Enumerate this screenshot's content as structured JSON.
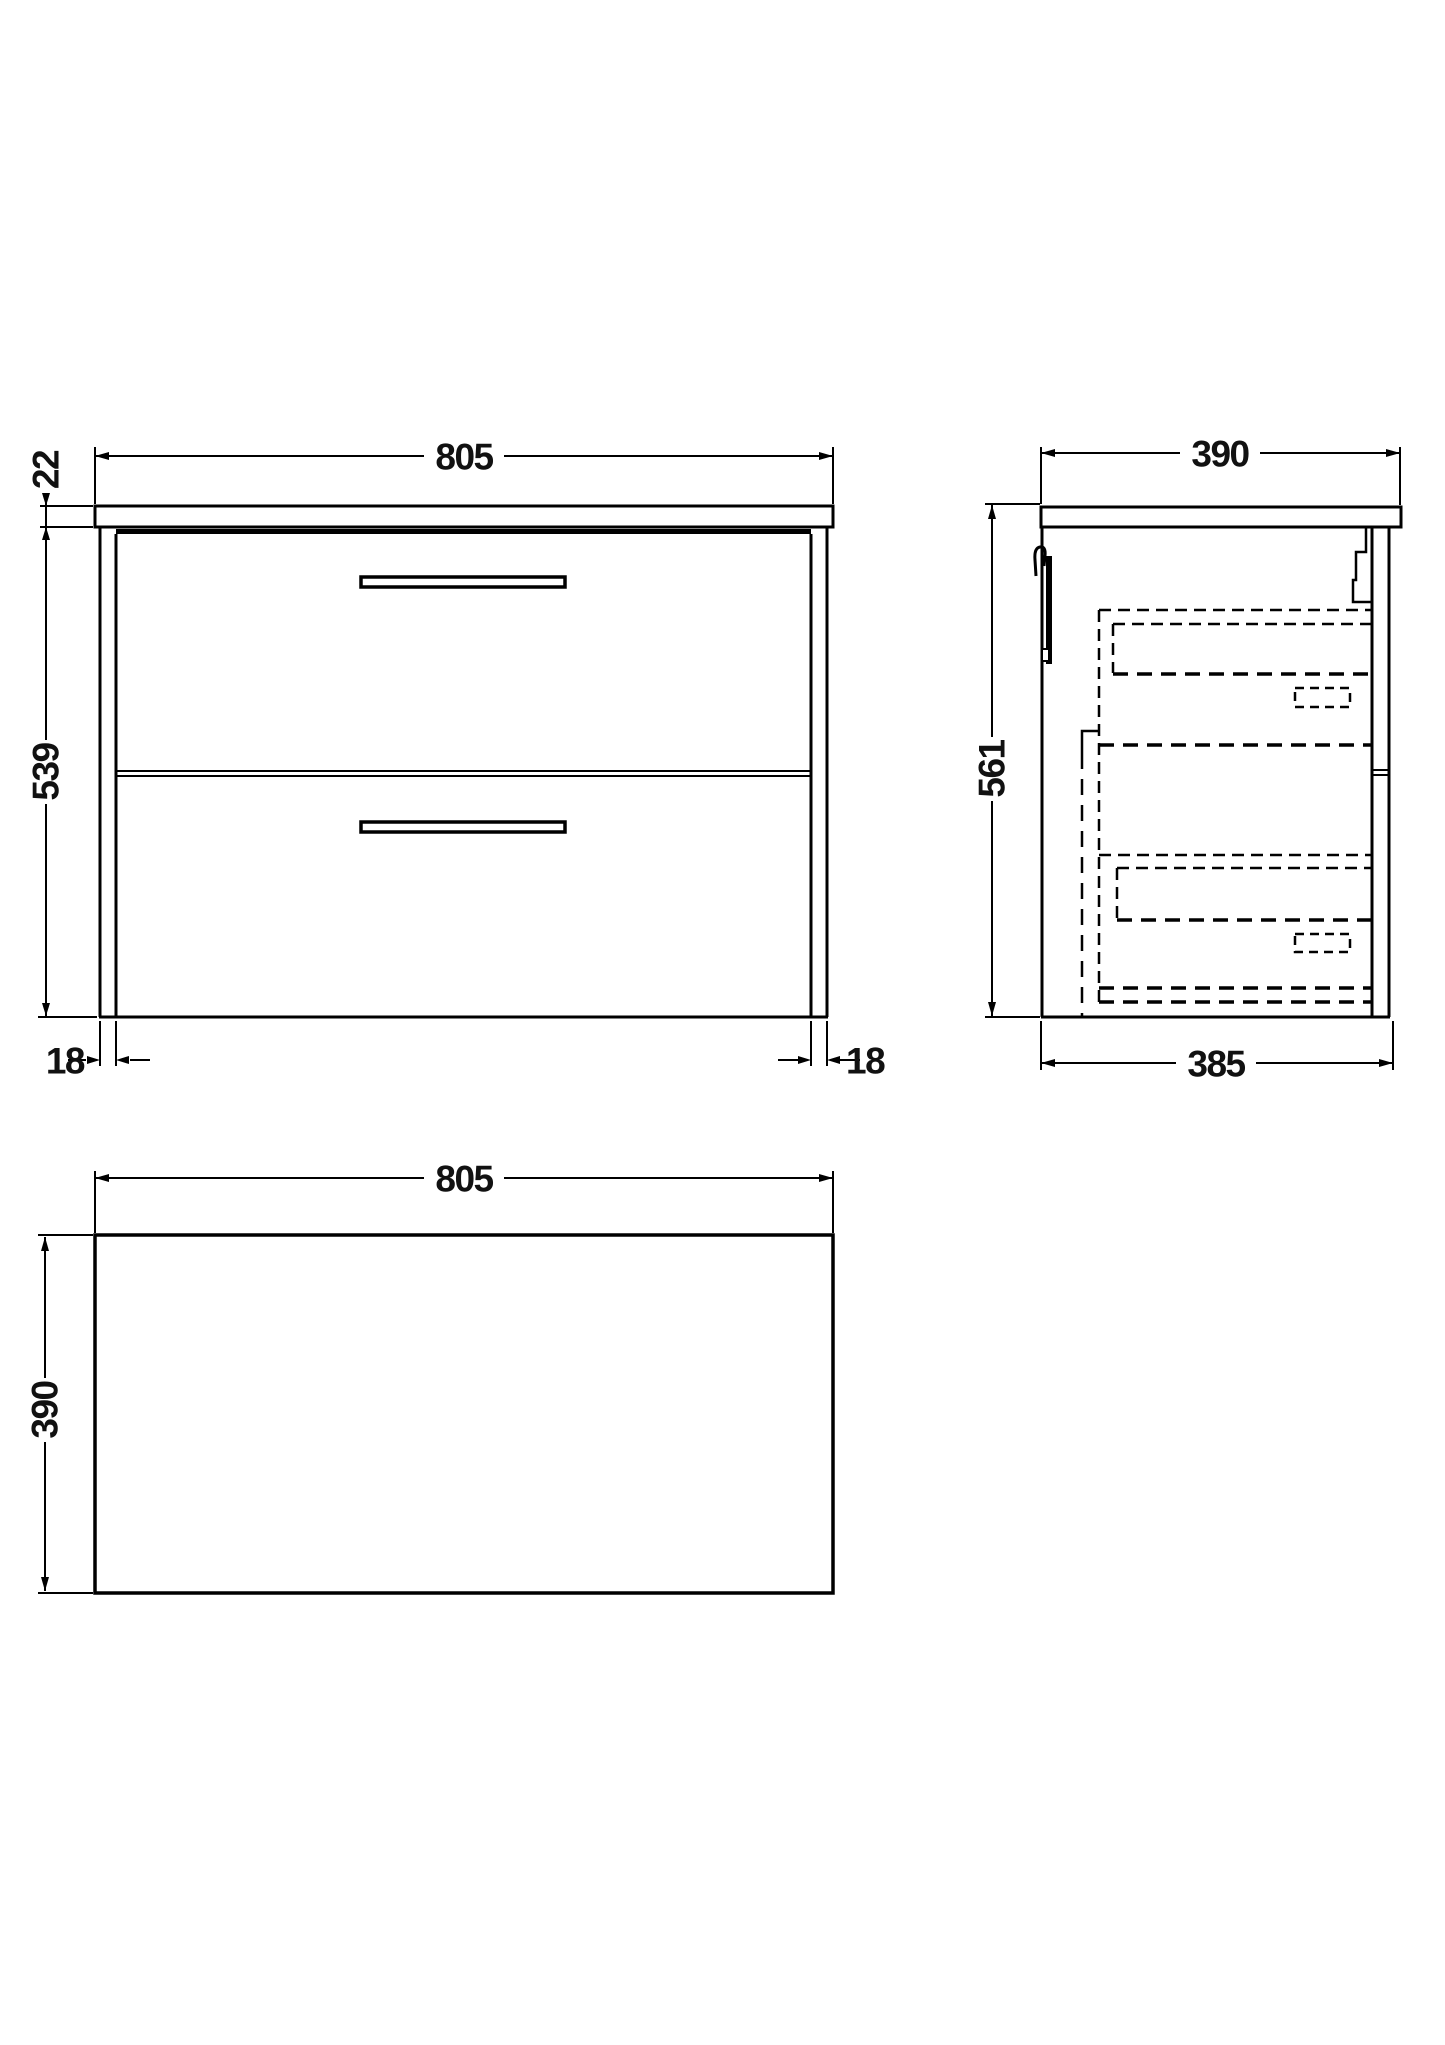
{
  "drawing": {
    "background_color": "#ffffff",
    "line_color": "#000000",
    "front_view": {
      "width": "805",
      "worktop_thickness": "22",
      "cabinet_height": "539",
      "left_panel_thickness": "18",
      "right_panel_thickness": "18"
    },
    "side_view": {
      "overall_depth": "390",
      "overall_height": "561",
      "cabinet_depth": "385"
    },
    "plan_view": {
      "width": "805",
      "depth": "390"
    }
  }
}
